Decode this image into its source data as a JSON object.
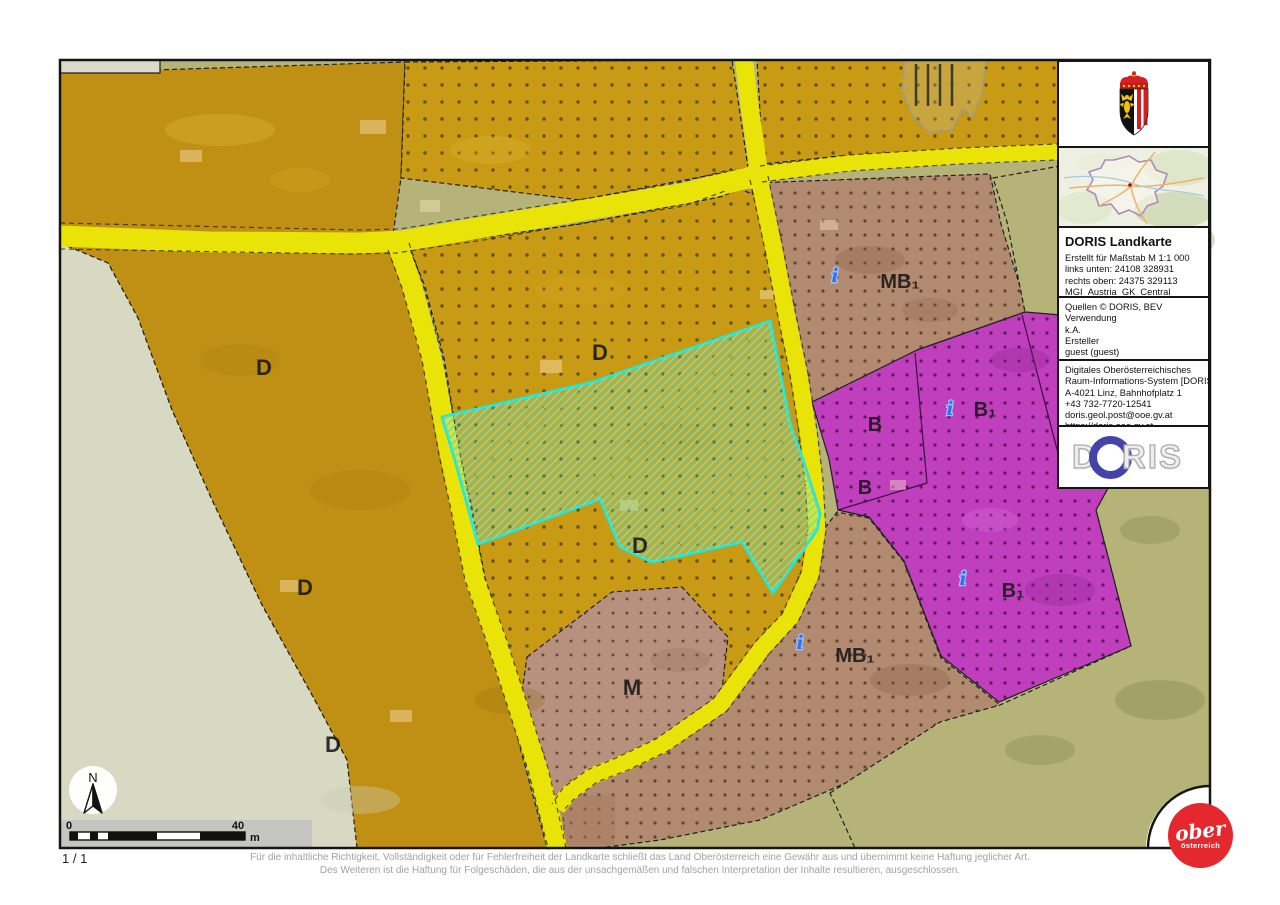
{
  "colors": {
    "zone_amber_solid": "#c09014",
    "zone_amber_dotted": "#c99a14",
    "zone_mixed_tan": "#b18a70",
    "zone_core_pink": "#b8917e",
    "zone_building_purple": "#bf3fbd",
    "zone_greenland_olive": "#b5b377",
    "zone_open_light": "#d7d9c3",
    "road_yellow": "#e9e307",
    "selection_cyan": "#1ae8dc",
    "selection_hatch_green": "#86d89a",
    "info_marker_blue": "#2f6ff0",
    "ober_logo_red": "#e5282e",
    "doris_logo_blue": "#4444a8"
  },
  "map": {
    "zone_labels": [
      {
        "zone": "D",
        "text": "D"
      },
      {
        "zone": "D",
        "text": "D"
      },
      {
        "zone": "D",
        "text": "D"
      },
      {
        "zone": "D",
        "text": "D"
      },
      {
        "zone": "D",
        "text": "D"
      },
      {
        "zone": "M",
        "text": "M"
      },
      {
        "zone": "MB1",
        "text": "MB₁"
      },
      {
        "zone": "MB1",
        "text": "MB₁"
      },
      {
        "zone": "B",
        "text": "B"
      },
      {
        "zone": "B",
        "text": "B"
      },
      {
        "zone": "B1",
        "text": "B₁"
      },
      {
        "zone": "B1",
        "text": "B₁"
      }
    ],
    "info_glyph": "i",
    "north_label": "N",
    "scale_bar": {
      "start_label": "0",
      "end_label": "40",
      "unit_label": "m"
    }
  },
  "panel": {
    "title": "DORIS Landkarte",
    "meta_lines": [
      "Erstellt für Maßstab M 1:1 000",
      "links unten: 24108 328931",
      "rechts oben: 24375 329113",
      "MGI_Austria_GK_Central"
    ],
    "source_lines": [
      "Quellen © DORIS, BEV",
      "Verwendung",
      "k.A.",
      "Ersteller",
      "guest (guest)",
      "Erstellungsdatum: 13.06.2025"
    ],
    "contact_lines": [
      "Digitales Oberösterreichisches",
      "Raum-Informations-System [DORIS]",
      "A-4021 Linz, Bahnhofplatz 1",
      "+43 732-7720-12541",
      "doris.geol.post@ooe.gv.at",
      "https://doris.ooe.gv.at"
    ],
    "doris_logo": {
      "left": "D",
      "right": "RIS"
    }
  },
  "footer": {
    "page_number": "1 / 1",
    "disclaimer_line1": "Für die inhaltliche Richtigkeit, Vollständigkeit oder für Fehlerfreiheit der Landkarte schließt das Land Oberösterreich eine Gewähr aus und übernimmt keine Haftung jeglicher Art.",
    "disclaimer_line2": "Des Weiteren ist die Haftung für Folgeschäden, die aus der unsachgemäßen und falschen Interpretation der Inhalte resultieren, ausgeschlossen."
  },
  "ober_logo": {
    "line1": "ober",
    "line2": "österreich"
  }
}
